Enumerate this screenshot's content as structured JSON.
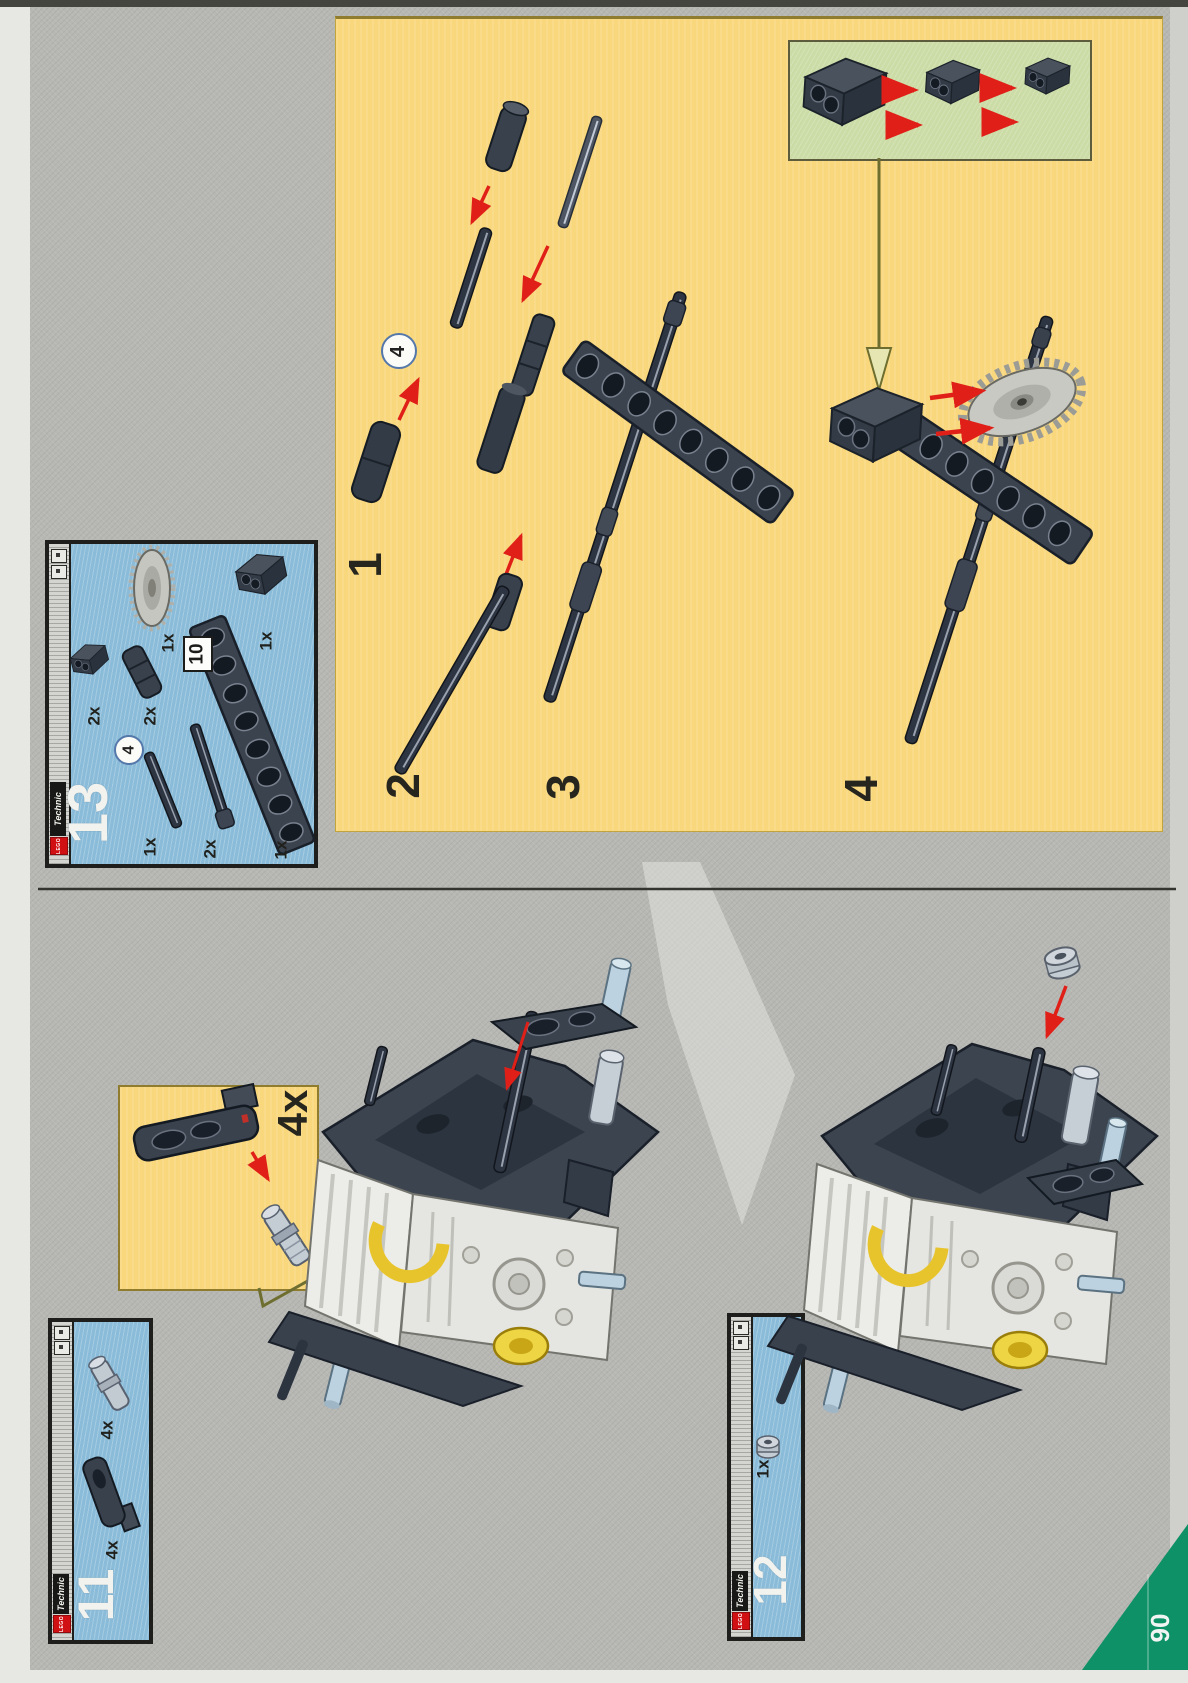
{
  "page": {
    "number": "90"
  },
  "brand": {
    "technic": "Technic",
    "lego": "LEGO"
  },
  "assembly_panel": {
    "step1": "1",
    "step2": "2",
    "step3": "3",
    "step4": "4",
    "axle_length_badge": "4"
  },
  "parts_box_13": {
    "number": "13",
    "beam_length_badge": "10",
    "axle_length_badge": "4",
    "crown_gear_count": "1x",
    "pin_brick_count": "2x",
    "axle_joiner_count": "2x",
    "beam_count": "1x",
    "axle_count": "1x",
    "stop_axle_count": "2x",
    "pin_brick_2x2_count": "1x"
  },
  "callout_4x": {
    "count": "4x"
  },
  "parts_box_11": {
    "number": "11",
    "connector_peg_count": "4x",
    "crank_arm_count": "4x"
  },
  "parts_box_12": {
    "number": "12",
    "half_bushing_count": "1x"
  }
}
